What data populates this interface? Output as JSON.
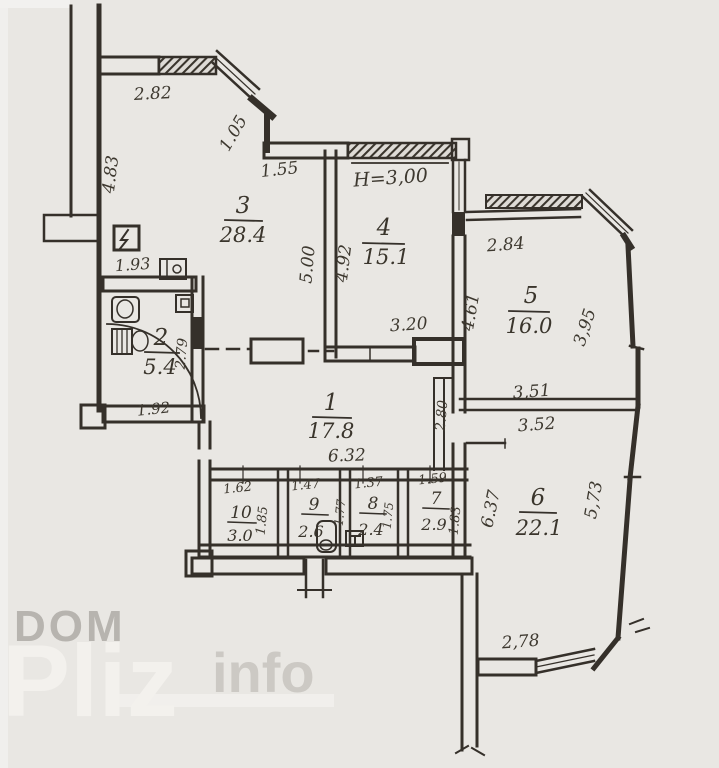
{
  "plan": {
    "type": "apartment-floor-plan-scan",
    "ceiling_height_label": "H=3,00",
    "rooms": {
      "r1": {
        "number": "1",
        "area": "17.8"
      },
      "r2": {
        "number": "2",
        "area": "5.4"
      },
      "r3": {
        "number": "3",
        "area": "28.4"
      },
      "r4": {
        "number": "4",
        "area": "15.1"
      },
      "r5": {
        "number": "5",
        "area": "16.0"
      },
      "r6": {
        "number": "6",
        "area": "22.1"
      },
      "r7": {
        "number": "7",
        "area": "2.9"
      },
      "r8": {
        "number": "8",
        "area": "2.4"
      },
      "r9": {
        "number": "9",
        "area": "2.6"
      },
      "r10": {
        "number": "10",
        "area": "3.0"
      }
    },
    "dims": {
      "top_left_width": "2.82",
      "left_height": "4.83",
      "diag_corner": "1.05",
      "top_mid": "1.55",
      "bath_width": "1.93",
      "bath_height": "2.79",
      "bath_bottom": "1.92",
      "r4_left_out": "5.00",
      "r4_left_in": "4.92",
      "r4_bottom": "3.20",
      "r5_top": "2.84",
      "r5_left": "4.61",
      "r5_right": "3,95",
      "r5_bottom": "3,51",
      "r6_top": "3.52",
      "r6_left": "6.37",
      "r6_right": "5,73",
      "r6_bottom": "2,78",
      "r1_right": "2.80",
      "r1_bottom": "6.32",
      "r10_top": "1.62",
      "r10_right": "1.85",
      "r9_top": "1.47",
      "r9_right": "1.77",
      "r8_top": "1.37",
      "r8_right": "1.75",
      "r7_top": "1.59",
      "r7_right": "1.83"
    },
    "watermark": {
      "dom": "DOM",
      "pliz": "Pliz",
      "info": "info"
    },
    "icons": [
      "electric-panel-icon",
      "washbasin-icon",
      "sink-icon",
      "toilet-icon",
      "cistern-icon",
      "boiler-icon",
      "t-box-icon"
    ],
    "colors": {
      "paper": "#e9e7e3",
      "ink": "#35302a",
      "watermark_gray": "#b7b4af",
      "watermark_light": "#f3f1ed"
    }
  }
}
